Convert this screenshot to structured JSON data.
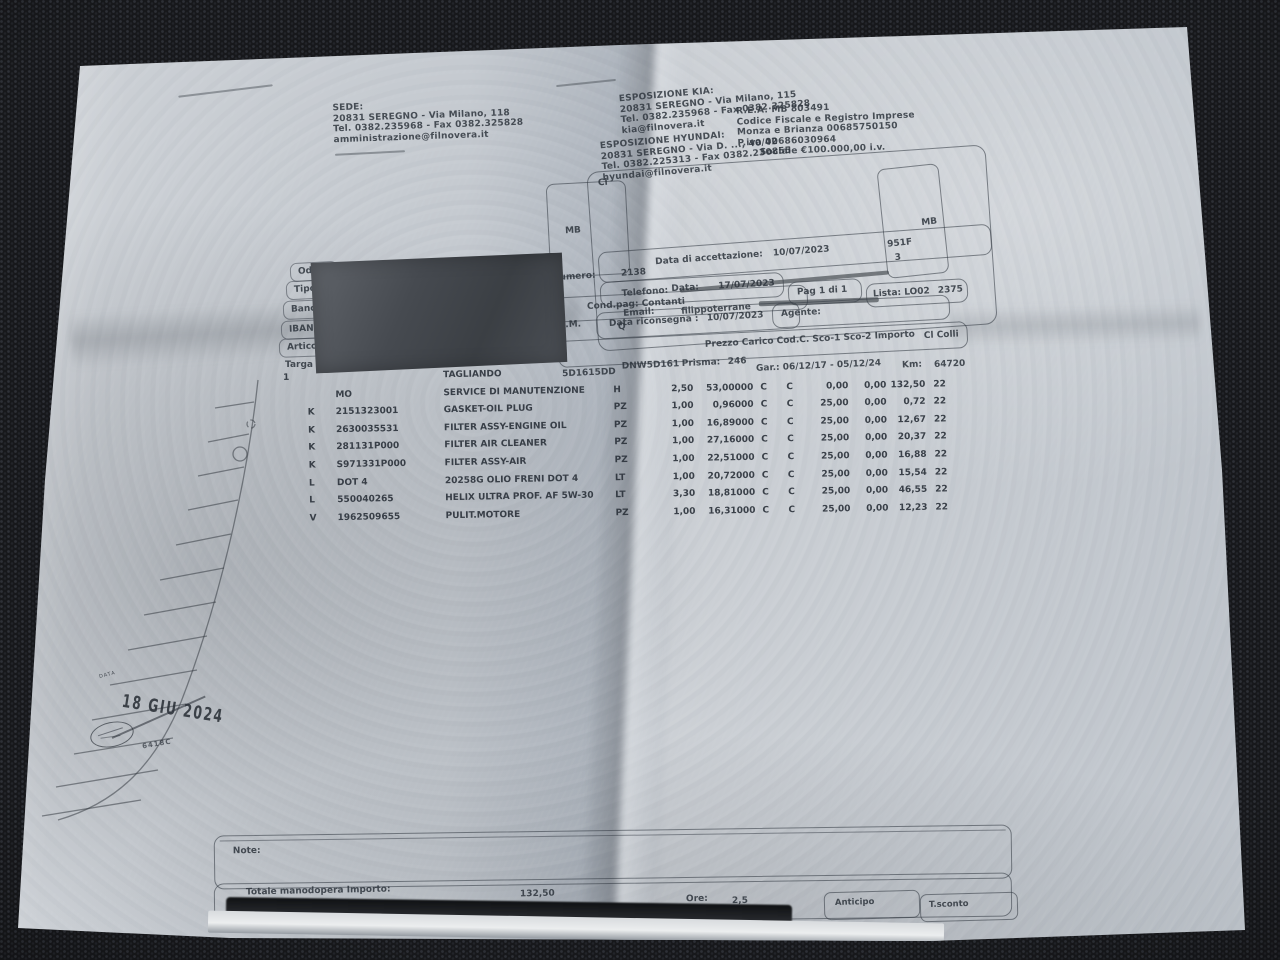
{
  "letterhead": {
    "sede": {
      "title": "SEDE:",
      "addr": "20831 SEREGNO - Via Milano, 118",
      "tel": "Tel. 0382.235968 - Fax 0382.325828",
      "email": "amministrazione@filnovera.it"
    },
    "kia": {
      "title": "ESPOSIZIONE KIA:",
      "addr": "20831 SEREGNO - Via Milano, 115",
      "tel": "Tel. 0382.235968 - Fax 0382.325828",
      "email": "kia@filnovera.it"
    },
    "hyundai": {
      "title": "ESPOSIZIONE HYUNDAI:",
      "addr": "20831 SEREGNO - Via D. ..., 40/42",
      "tel": "Tel. 0382.225313 - Fax 0382.230855",
      "email": "hyundai@filnovera.it"
    },
    "legal": {
      "rea": "R.E.A. MB 803491",
      "cf1": "Codice Fiscale e Registro Imprese",
      "cf2": "Monza e Brianza 00685750150",
      "piva": "P.iva 00686030964",
      "capitale": "Sociale €100.000,00 i.v."
    }
  },
  "customer_card": {
    "fragment": "Cl",
    "telefono_label": "Telefono:",
    "email_label": "Email:",
    "email_value": "filippoterrane",
    "mb_left": "MB",
    "mb_right": "MB",
    "code_right": "951F",
    "digit": "3"
  },
  "accept": {
    "label": "Data di accettazione:",
    "value": "10/07/2023"
  },
  "numero": {
    "label": "Numero:",
    "value": "2138"
  },
  "data_doc": {
    "label": "Data:",
    "value": "17/07/2023"
  },
  "pag": {
    "label": "Pag 1 di 1"
  },
  "lista": {
    "label": "Lista: LO02",
    "value": "2375"
  },
  "condpag": {
    "label": "Cond.pag: Contanti"
  },
  "agente": {
    "label": "Agente:"
  },
  "riconsegna": {
    "label": "Data riconsegna :",
    "value": "10/07/2023"
  },
  "um_header": {
    "um": "U.M.",
    "q": "Q"
  },
  "price_header": {
    "text": "Prezzo   Carico Cod.C. Sco-1 Sco-2 Importo",
    "colli": "Cl Colli"
  },
  "left_labels": [
    "Odl C",
    "Tipo D",
    "Banca",
    "IBAN",
    "Artico",
    "Targa"
  ],
  "vehicle": {
    "vin": "5D1615DD",
    "vin2": "DNW5D161",
    "prisma_label": "Prisma:",
    "prisma_value": "246",
    "gar": "Gar.:  06/12/17 - 05/12/24",
    "km_label": "Km:",
    "km_value": "64720"
  },
  "table": {
    "rows": [
      {
        "n": "1",
        "tipo": "",
        "code": "",
        "desc": "TAGLIANDO",
        "um": "",
        "qty": "",
        "price": "",
        "c1": "",
        "c2": "",
        "sco1": "",
        "sco2": "",
        "imp": "",
        "iva": ""
      },
      {
        "n": "",
        "tipo": "",
        "code": "MO",
        "desc": "SERVICE DI MANUTENZIONE",
        "um": "H",
        "qty": "2,50",
        "price": "53,00000",
        "c1": "C",
        "c2": "C",
        "sco1": "0,00",
        "sco2": "0,00",
        "imp": "132,50",
        "iva": "22"
      },
      {
        "n": "",
        "tipo": "K",
        "code": "2151323001",
        "desc": "GASKET-OIL PLUG",
        "um": "PZ",
        "qty": "1,00",
        "price": "0,96000",
        "c1": "C",
        "c2": "C",
        "sco1": "25,00",
        "sco2": "0,00",
        "imp": "0,72",
        "iva": "22"
      },
      {
        "n": "",
        "tipo": "K",
        "code": "2630035531",
        "desc": "FILTER ASSY-ENGINE OIL",
        "um": "PZ",
        "qty": "1,00",
        "price": "16,89000",
        "c1": "C",
        "c2": "C",
        "sco1": "25,00",
        "sco2": "0,00",
        "imp": "12,67",
        "iva": "22"
      },
      {
        "n": "",
        "tipo": "K",
        "code": "281131P000",
        "desc": "FILTER AIR CLEANER",
        "um": "PZ",
        "qty": "1,00",
        "price": "27,16000",
        "c1": "C",
        "c2": "C",
        "sco1": "25,00",
        "sco2": "0,00",
        "imp": "20,37",
        "iva": "22"
      },
      {
        "n": "",
        "tipo": "K",
        "code": "S971331P000",
        "desc": "FILTER ASSY-AIR",
        "um": "PZ",
        "qty": "1,00",
        "price": "22,51000",
        "c1": "C",
        "c2": "C",
        "sco1": "25,00",
        "sco2": "0,00",
        "imp": "16,88",
        "iva": "22"
      },
      {
        "n": "",
        "tipo": "L",
        "code": "DOT 4",
        "desc": "20258G OLIO FRENI DOT 4",
        "um": "LT",
        "qty": "1,00",
        "price": "20,72000",
        "c1": "C",
        "c2": "C",
        "sco1": "25,00",
        "sco2": "0,00",
        "imp": "15,54",
        "iva": "22"
      },
      {
        "n": "",
        "tipo": "L",
        "code": "550040265",
        "desc": "HELIX ULTRA PROF. AF 5W-30",
        "um": "LT",
        "qty": "3,30",
        "price": "18,81000",
        "c1": "C",
        "c2": "C",
        "sco1": "25,00",
        "sco2": "0,00",
        "imp": "46,55",
        "iva": "22"
      },
      {
        "n": "",
        "tipo": "V",
        "code": "1962509655",
        "desc": "PULIT.MOTORE",
        "um": "PZ",
        "qty": "1,00",
        "price": "16,31000",
        "c1": "C",
        "c2": "C",
        "sco1": "25,00",
        "sco2": "0,00",
        "imp": "12,23",
        "iva": "22"
      }
    ]
  },
  "stamp": {
    "data_label": "DATA",
    "date": "18 GIU 2024",
    "code": "6418C"
  },
  "footer": {
    "note_label": "Note:",
    "totale_label": "Totale manodopera  Importo:",
    "totale_value": "132,50",
    "ore_label": "Ore:",
    "ore_value": "2,5",
    "anticipo": "Anticipo",
    "tsconto": "T.sconto"
  }
}
